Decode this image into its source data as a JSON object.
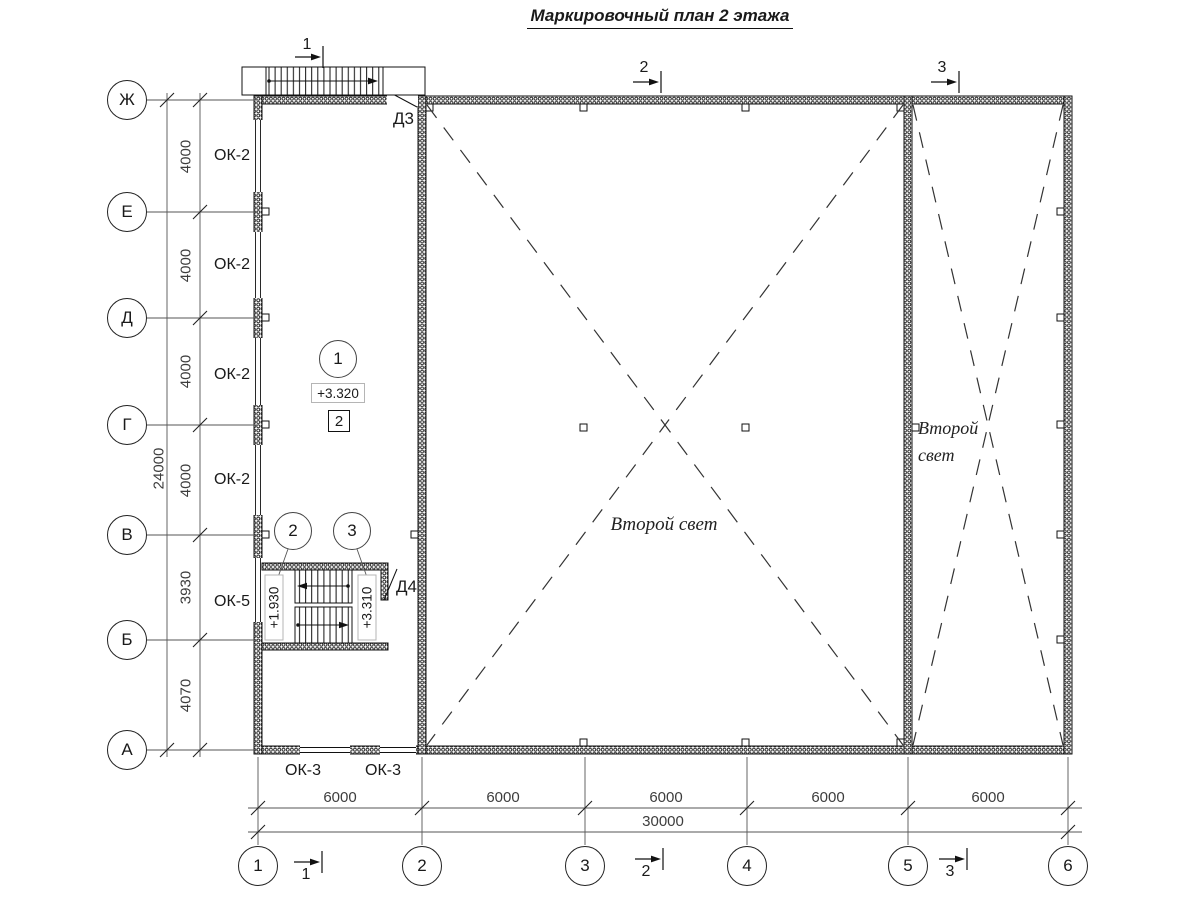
{
  "title": "Маркировочный план 2 этажа",
  "axes": {
    "rows": [
      {
        "label": "Ж"
      },
      {
        "label": "Е"
      },
      {
        "label": "Д"
      },
      {
        "label": "Г"
      },
      {
        "label": "В"
      },
      {
        "label": "Б"
      },
      {
        "label": "А"
      }
    ],
    "cols": [
      {
        "label": "1"
      },
      {
        "label": "2"
      },
      {
        "label": "3"
      },
      {
        "label": "4"
      },
      {
        "label": "5"
      },
      {
        "label": "6"
      }
    ]
  },
  "dimensions": {
    "left_spans": [
      "4000",
      "4000",
      "4000",
      "4000",
      "3930",
      "4070"
    ],
    "left_total": "24000",
    "bottom_spans": [
      "6000",
      "6000",
      "6000",
      "6000",
      "6000"
    ],
    "bottom_total": "30000"
  },
  "marks": {
    "ok2": "ОК-2",
    "ok5": "ОК-5",
    "ok3": "ОК-3",
    "d3": "Д3",
    "d4": "Д4"
  },
  "room": {
    "axis_mark": "1",
    "level": "+3.320",
    "zone_mark": "2"
  },
  "stair": {
    "mark_left": "2",
    "mark_right": "3",
    "level_left": "+1.930",
    "level_right": "+3.310"
  },
  "sections": {
    "s1": "1",
    "s2": "2",
    "s3": "3"
  },
  "annotations": {
    "second_light": "Второй свет",
    "second_light_line1": "Второй",
    "second_light_line2": "свет"
  }
}
